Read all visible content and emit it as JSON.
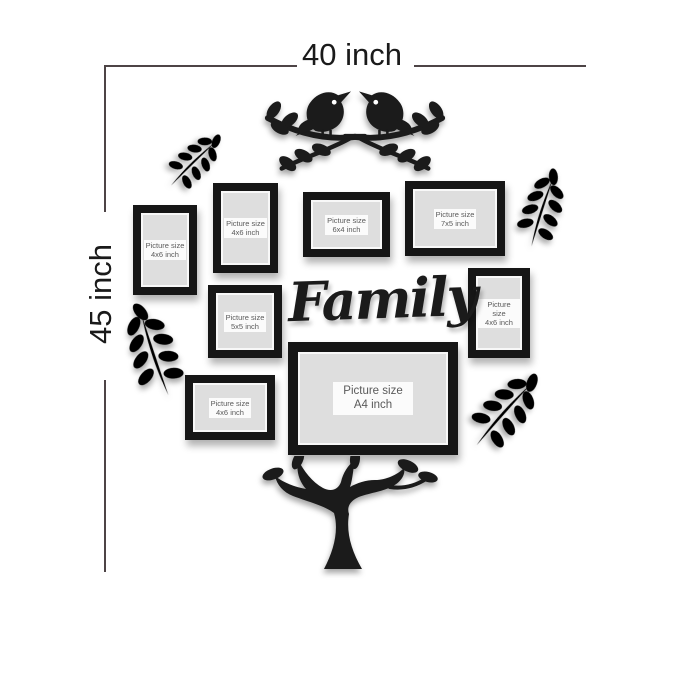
{
  "dimensions": {
    "width_label": "40 inch",
    "height_label": "45 inch"
  },
  "title": {
    "word": "Family"
  },
  "frames": [
    {
      "name": "frame-4x6-top-left",
      "line1": "Picture size",
      "line2": "4x6 inch"
    },
    {
      "name": "frame-4x6-upper-mid",
      "line1": "Picture size",
      "line2": "4x6 inch"
    },
    {
      "name": "frame-6x4",
      "line1": "Picture size",
      "line2": "6x4 inch"
    },
    {
      "name": "frame-7x5",
      "line1": "Picture size",
      "line2": "7x5 inch"
    },
    {
      "name": "frame-5x5",
      "line1": "Picture size",
      "line2": "5x5 inch"
    },
    {
      "name": "frame-4x6-right",
      "line1": "Picture size",
      "line2": "4x6 inch"
    },
    {
      "name": "frame-4x6-bottom-left",
      "line1": "Picture size",
      "line2": "4x6 inch"
    },
    {
      "name": "frame-a4",
      "line1": "Picture size",
      "line2": "A4 inch"
    }
  ],
  "decorations": [
    {
      "icon": "love-birds-branch-icon",
      "position": "top-center"
    },
    {
      "icon": "leaf-sprig-icon",
      "position": "top-left"
    },
    {
      "icon": "leaf-sprig-icon",
      "position": "upper-right"
    },
    {
      "icon": "leaf-sprig-icon",
      "position": "mid-left"
    },
    {
      "icon": "leaf-sprig-icon",
      "position": "bottom-right"
    },
    {
      "icon": "tree-trunk-icon",
      "position": "bottom-center"
    }
  ],
  "colors": {
    "background": "#ffffff",
    "silhouette": "#1b1b1b",
    "frame_border": "#161616",
    "frame_mat": "#dedede",
    "label_bg": "#fbfbfb",
    "label_text": "#5a5a5a",
    "dimension_line": "#4d4446",
    "dimension_text": "#1a1a1a"
  }
}
